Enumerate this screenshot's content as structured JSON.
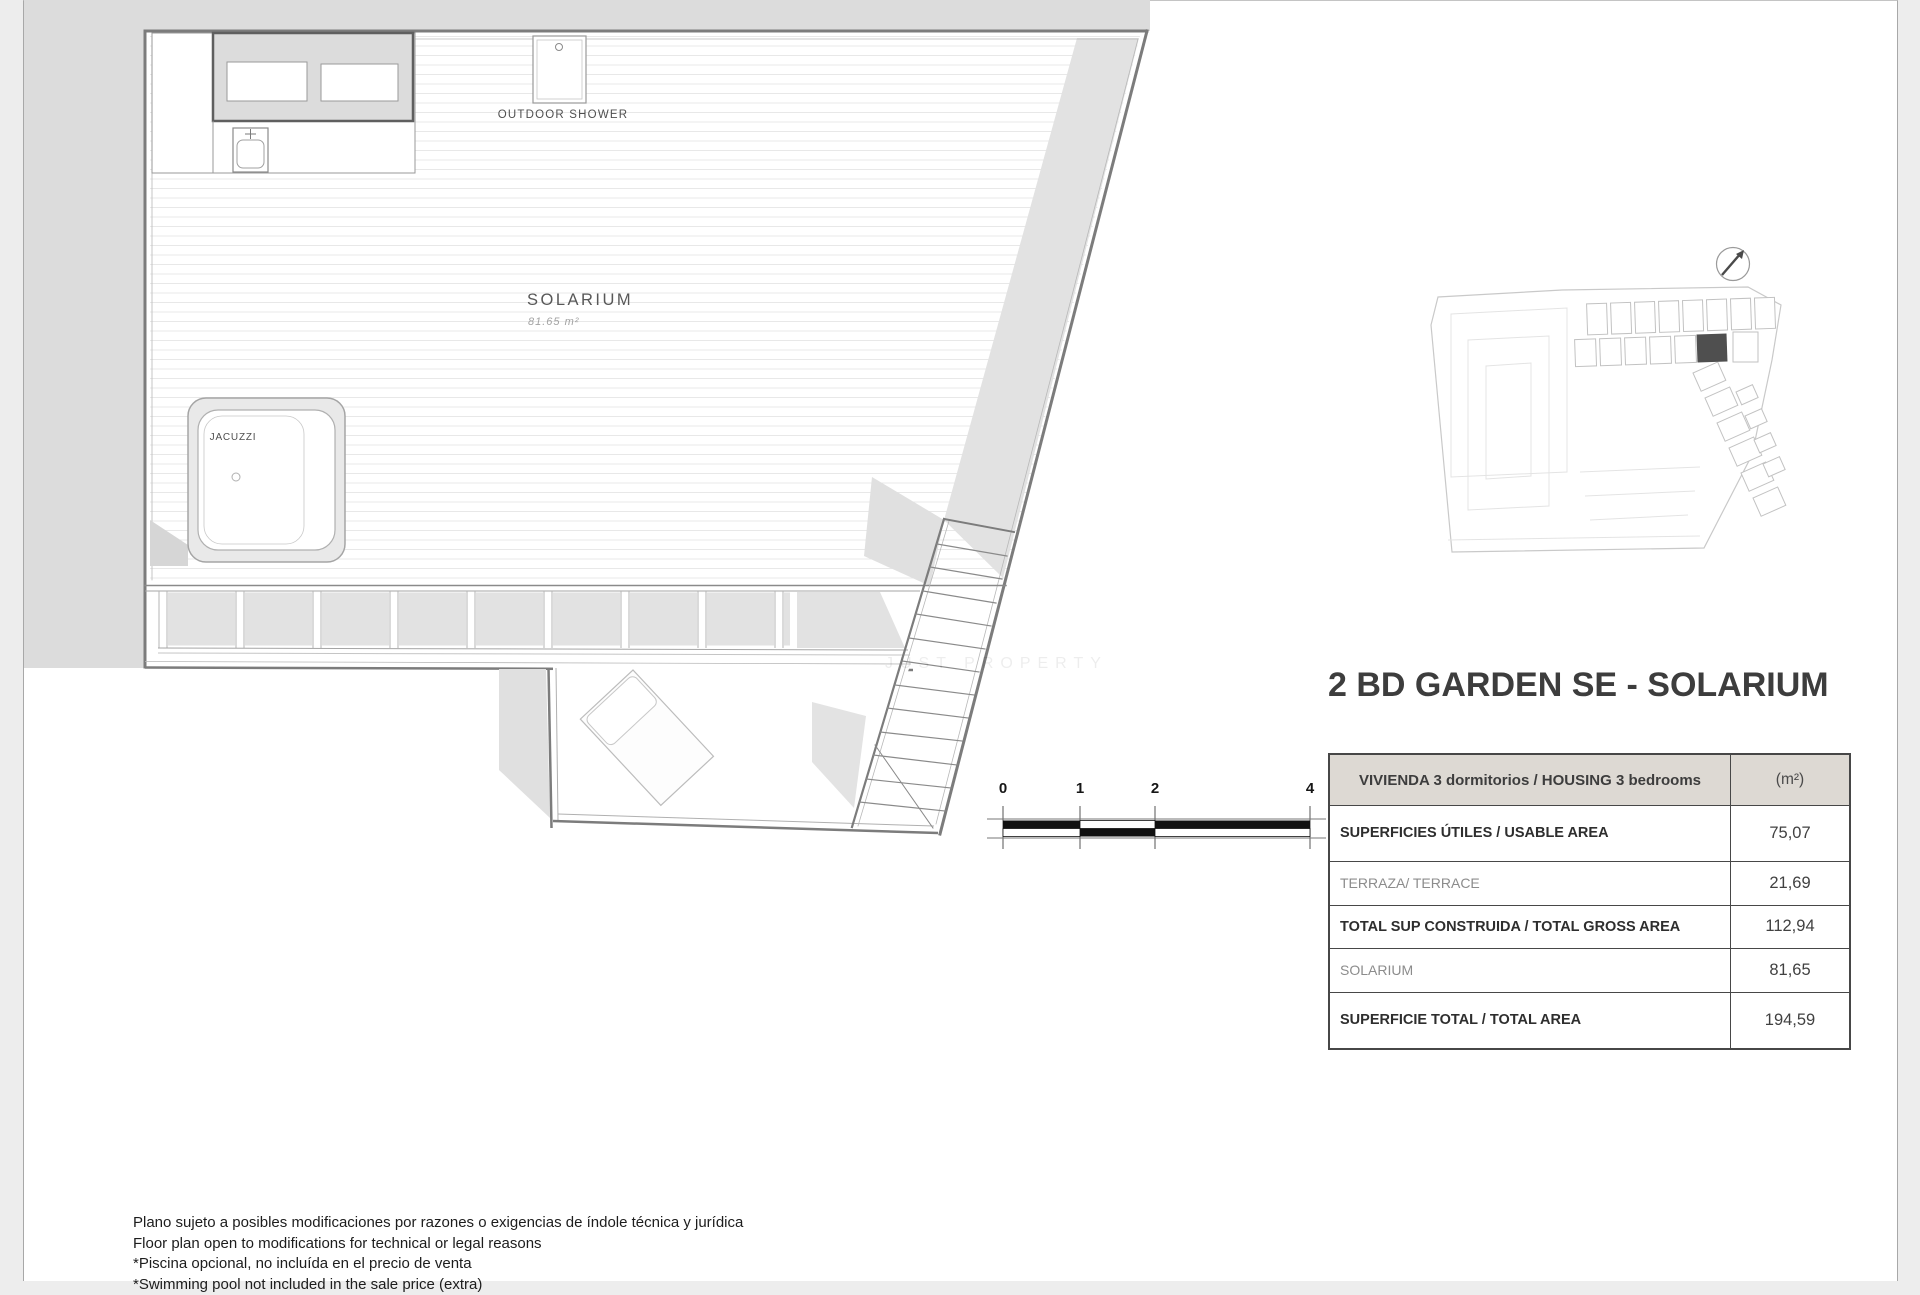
{
  "colors": {
    "margin_bg": "#ededed",
    "page_bg": "#ffffff",
    "neighbor": "#dcdcdc",
    "fill": "#e2e2e2",
    "line": "#9a9a9a",
    "line_strong": "#7c7c7c",
    "line_light": "#c9c9c9",
    "deck": "#e8e8e8",
    "dark_unit": "#4f4f4f",
    "header_bg": "#ddd9d3",
    "border": "#474747",
    "ink": "#3d3d3d",
    "ink_light": "#8c8c8c"
  },
  "title": "2 BD GARDEN SE - SOLARIUM",
  "plan": {
    "solarium_label": "SOLARIUM",
    "solarium_area": "81.65 m²",
    "jacuzzi_label": "JACUZZI",
    "outdoor_shower_label": "OUTDOOR SHOWER"
  },
  "scale_bar": {
    "labels": [
      "0",
      "1",
      "2",
      "4"
    ]
  },
  "area_table": {
    "header": {
      "label": "VIVIENDA 3 dormitorios / HOUSING 3 bedrooms",
      "unit": "(m²)"
    },
    "rows": [
      {
        "label": "SUPERFICIES ÚTILES / USABLE AREA",
        "value": "75,07"
      },
      {
        "label": "TERRAZA/ TERRACE",
        "value": "21,69"
      },
      {
        "label": "TOTAL SUP CONSTRUIDA / TOTAL GROSS AREA",
        "value": "112,94"
      },
      {
        "label": "SOLARIUM",
        "value": "81,65"
      },
      {
        "label": "SUPERFICIE TOTAL / TOTAL AREA",
        "value": "194,59"
      }
    ]
  },
  "disclaimers": [
    "Plano sujeto a posibles modificaciones por razones o exigencias de índole técnica y jurídica",
    "Floor plan open to modifications for technical or legal reasons",
    "*Piscina opcional, no incluída en el precio de venta",
    "*Swimming pool not included in the sale price (extra)"
  ],
  "watermark": "JUST PROPERTY"
}
